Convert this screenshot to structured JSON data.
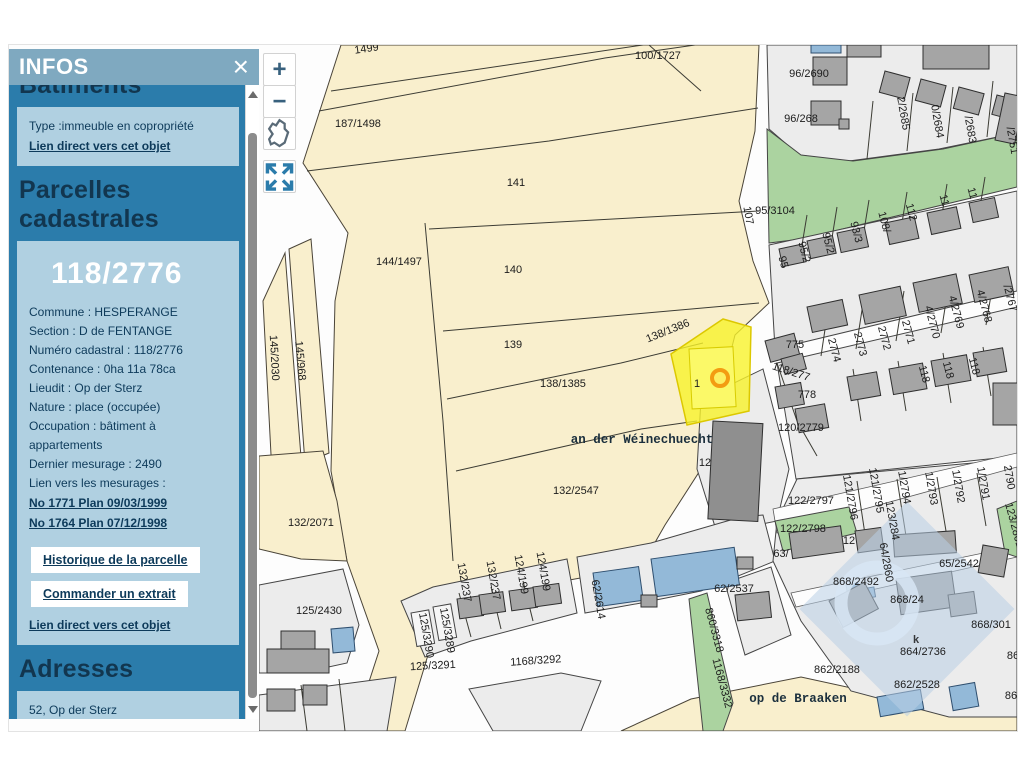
{
  "panel": {
    "title": "INFOS",
    "close": "×",
    "batiments": {
      "heading": "Bâtiments",
      "type_line": "Type :immeuble en copropriété",
      "link": "Lien direct vers cet objet"
    },
    "parcelles": {
      "heading": "Parcelles cadastrales",
      "number": "118/2776",
      "fields": [
        "Commune : HESPERANGE",
        "Section : D de FENTANGE",
        "Numéro cadastral : 118/2776",
        "Contenance : 0ha 11a 78ca",
        "Lieudit : Op der Sterz",
        "Nature : place (occupée)",
        "Occupation : bâtiment à appartements",
        "Dernier mesurage : 2490",
        "Lien vers les mesurages :"
      ],
      "measure_links": [
        "No 1771 Plan 09/03/1999",
        "No 1764 Plan 07/12/1998"
      ],
      "buttons": [
        "Historique de la parcelle",
        "Commander un extrait"
      ],
      "link": "Lien direct vers cet objet"
    },
    "adresses": {
      "heading": "Adresses",
      "lines": [
        "52, Op der Sterz",
        "L-5823 Fentange"
      ],
      "link": "Lien direct vers cet objet"
    }
  },
  "map": {
    "controls": {
      "zoom_in": "+",
      "zoom_out": "−"
    },
    "watermark_glyph": "k",
    "selected_parcel": "118/2776",
    "labels": [
      {
        "t": "1499",
        "x": 366,
        "y": 51,
        "r": -8
      },
      {
        "t": "187/1498",
        "x": 357,
        "y": 126
      },
      {
        "t": "100/1727",
        "x": 657,
        "y": 58
      },
      {
        "t": "141",
        "x": 515,
        "y": 185
      },
      {
        "t": "144/1497",
        "x": 398,
        "y": 264
      },
      {
        "t": "140",
        "x": 512,
        "y": 272
      },
      {
        "t": "139",
        "x": 512,
        "y": 347
      },
      {
        "t": "138/1386",
        "x": 668,
        "y": 333,
        "r": -22
      },
      {
        "t": "138/1385",
        "x": 562,
        "y": 386
      },
      {
        "t": "132/2547",
        "x": 575,
        "y": 493
      },
      {
        "t": "132/2071",
        "x": 310,
        "y": 525
      },
      {
        "t": "145/2030",
        "x": 270,
        "y": 357,
        "r": 87
      },
      {
        "t": "145/968",
        "x": 296,
        "y": 360,
        "r": 85
      },
      {
        "t": "125/2430",
        "x": 318,
        "y": 613
      },
      {
        "t": "107",
        "x": 744,
        "y": 215,
        "r": 80
      },
      {
        "t": "95/3104",
        "x": 774,
        "y": 213
      },
      {
        "t": "96/2690",
        "x": 808,
        "y": 76
      },
      {
        "t": "96/268",
        "x": 800,
        "y": 121
      },
      {
        "t": "2/2685",
        "x": 899,
        "y": 113,
        "r": 80
      },
      {
        "t": "0/2684",
        "x": 933,
        "y": 121,
        "r": 80
      },
      {
        "t": "/2683",
        "x": 966,
        "y": 129,
        "r": 80
      },
      {
        "t": "/2751",
        "x": 1008,
        "y": 140,
        "r": 80
      },
      {
        "t": "95",
        "x": 779,
        "y": 262,
        "r": 75
      },
      {
        "t": "95/2",
        "x": 800,
        "y": 252,
        "r": 75
      },
      {
        "t": "95/2",
        "x": 824,
        "y": 243,
        "r": 75
      },
      {
        "t": "93/3",
        "x": 852,
        "y": 232,
        "r": 75
      },
      {
        "t": "108/",
        "x": 880,
        "y": 222,
        "r": 75
      },
      {
        "t": "112",
        "x": 907,
        "y": 212,
        "r": 75
      },
      {
        "t": "11",
        "x": 940,
        "y": 200,
        "r": 75
      },
      {
        "t": "11",
        "x": 968,
        "y": 193,
        "r": 75
      },
      {
        "t": "2774",
        "x": 830,
        "y": 350,
        "r": 75
      },
      {
        "t": "2773",
        "x": 856,
        "y": 344,
        "r": 75
      },
      {
        "t": "2772",
        "x": 880,
        "y": 338,
        "r": 75
      },
      {
        "t": "2771",
        "x": 904,
        "y": 332,
        "r": 75
      },
      {
        "t": "4/2770",
        "x": 928,
        "y": 322,
        "r": 75
      },
      {
        "t": "4/2769",
        "x": 952,
        "y": 312,
        "r": 75
      },
      {
        "t": "4/2768",
        "x": 980,
        "y": 306,
        "r": 75
      },
      {
        "t": "/2767",
        "x": 1006,
        "y": 298,
        "r": 75
      },
      {
        "t": "118",
        "x": 920,
        "y": 374,
        "r": 75
      },
      {
        "t": "118",
        "x": 944,
        "y": 370,
        "r": 75
      },
      {
        "t": "118",
        "x": 970,
        "y": 366,
        "r": 75
      },
      {
        "t": "775",
        "x": 794,
        "y": 347
      },
      {
        "t": "118/277",
        "x": 789,
        "y": 374,
        "r": 18
      },
      {
        "t": "778",
        "x": 806,
        "y": 397
      },
      {
        "t": "120/2779",
        "x": 800,
        "y": 430
      },
      {
        "t": "122/2797",
        "x": 810,
        "y": 503
      },
      {
        "t": "122/2798",
        "x": 802,
        "y": 531
      },
      {
        "t": "63/",
        "x": 780,
        "y": 556
      },
      {
        "t": "12",
        "x": 848,
        "y": 543
      },
      {
        "t": "123/284",
        "x": 888,
        "y": 520,
        "r": 80
      },
      {
        "t": "64/2860",
        "x": 882,
        "y": 562,
        "r": 80
      },
      {
        "t": "65/2542",
        "x": 958,
        "y": 566
      },
      {
        "t": "868/2492",
        "x": 855,
        "y": 584
      },
      {
        "t": "868/24",
        "x": 906,
        "y": 602
      },
      {
        "t": "868/301",
        "x": 990,
        "y": 627
      },
      {
        "t": "864/2736",
        "x": 922,
        "y": 654
      },
      {
        "t": "862/2188",
        "x": 836,
        "y": 672
      },
      {
        "t": "862/2528",
        "x": 916,
        "y": 687
      },
      {
        "t": "86",
        "x": 1012,
        "y": 658
      },
      {
        "t": "86",
        "x": 1010,
        "y": 698
      },
      {
        "t": "121/2796",
        "x": 846,
        "y": 497,
        "r": 80
      },
      {
        "t": "121/2795",
        "x": 872,
        "y": 490,
        "r": 80
      },
      {
        "t": "1/2794",
        "x": 900,
        "y": 487,
        "r": 80
      },
      {
        "t": "1/2793",
        "x": 927,
        "y": 488,
        "r": 80
      },
      {
        "t": "1/2792",
        "x": 954,
        "y": 486,
        "r": 80
      },
      {
        "t": "1/2791",
        "x": 979,
        "y": 483,
        "r": 80
      },
      {
        "t": "2790",
        "x": 1005,
        "y": 477,
        "r": 80
      },
      {
        "t": "123/2801",
        "x": 1010,
        "y": 525,
        "r": 75
      },
      {
        "t": "62/2537",
        "x": 733,
        "y": 591
      },
      {
        "t": "62/2614",
        "x": 594,
        "y": 599,
        "r": 80
      },
      {
        "t": "860/3318",
        "x": 710,
        "y": 630,
        "r": 75
      },
      {
        "t": "1168/3332",
        "x": 718,
        "y": 683,
        "r": 75
      },
      {
        "t": "1168/3292",
        "x": 535,
        "y": 663,
        "r": -4
      },
      {
        "t": "125/3291",
        "x": 432,
        "y": 668,
        "r": -3
      },
      {
        "t": "125/3290",
        "x": 422,
        "y": 635,
        "r": 80
      },
      {
        "t": "125/3289",
        "x": 443,
        "y": 630,
        "r": 80
      },
      {
        "t": "132/237",
        "x": 460,
        "y": 582,
        "r": 80
      },
      {
        "t": "132/237",
        "x": 489,
        "y": 580,
        "r": 80
      },
      {
        "t": "124/199",
        "x": 517,
        "y": 574,
        "r": 80
      },
      {
        "t": "124/199",
        "x": 539,
        "y": 571,
        "r": 80
      },
      {
        "t": "1",
        "x": 696,
        "y": 386
      },
      {
        "t": "12",
        "x": 704,
        "y": 465
      },
      {
        "t": "an der Wéinechuecht",
        "x": 641,
        "y": 442,
        "k": "street"
      },
      {
        "t": "op de Braaken",
        "x": 797,
        "y": 701,
        "k": "street"
      }
    ]
  },
  "colors": {
    "panel_header": "#7fa9c0",
    "panel_body": "#2b7cab",
    "panel_box": "#b0d0e1",
    "panel_text": "#0d3a5a",
    "parcel_fill": "#f9efcd",
    "residential_fill": "#ececec",
    "green_fill": "#abd3a0",
    "building_fill": "#a5a5a5",
    "blue_building_fill": "#93b9d8",
    "highlight_fill": "#f8f32b",
    "marker_ring": "#f39c12",
    "watermark": "#b9cfe6"
  }
}
